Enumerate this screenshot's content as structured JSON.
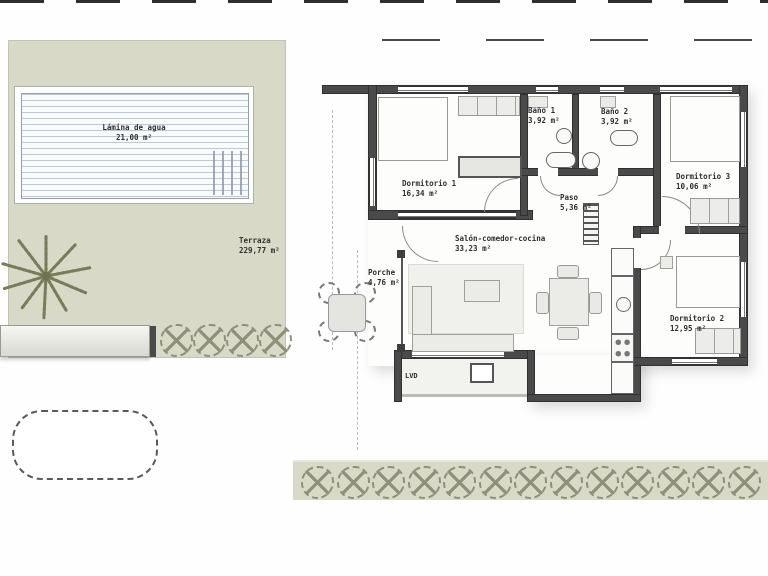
{
  "plan": {
    "rooms": [
      {
        "id": "lamina",
        "name": "Lámina de agua",
        "area": "21,00 m²"
      },
      {
        "id": "terraza",
        "name": "Terraza",
        "area": "229,77 m²"
      },
      {
        "id": "dormitorio1",
        "name": "Dormitorio 1",
        "area": "16,34 m²"
      },
      {
        "id": "bano1",
        "name": "Baño 1",
        "area": "3,92 m²"
      },
      {
        "id": "bano2",
        "name": "Baño 2",
        "area": "3,92 m²"
      },
      {
        "id": "dormitorio3",
        "name": "Dormitorio 3",
        "area": "10,06 m²"
      },
      {
        "id": "paso",
        "name": "Paso",
        "area": "5,36 m²"
      },
      {
        "id": "salon",
        "name": "Salón-comedor-cocina",
        "area": "33,23 m²"
      },
      {
        "id": "porche",
        "name": "Porche",
        "area": "4,76 m²"
      },
      {
        "id": "dormitorio2",
        "name": "Dormitorio 2",
        "area": "12,95 m²"
      }
    ],
    "labels": {
      "utility": "LVD"
    },
    "garden": {
      "left_shrubs": 4,
      "bottom_shrubs": 13
    },
    "colors": {
      "terrace": "#d8d9c7",
      "wall": "#4a4a4a",
      "water_line": "#8da0b8",
      "furniture": "#ebebe8",
      "shrub": "#8e9077"
    }
  }
}
